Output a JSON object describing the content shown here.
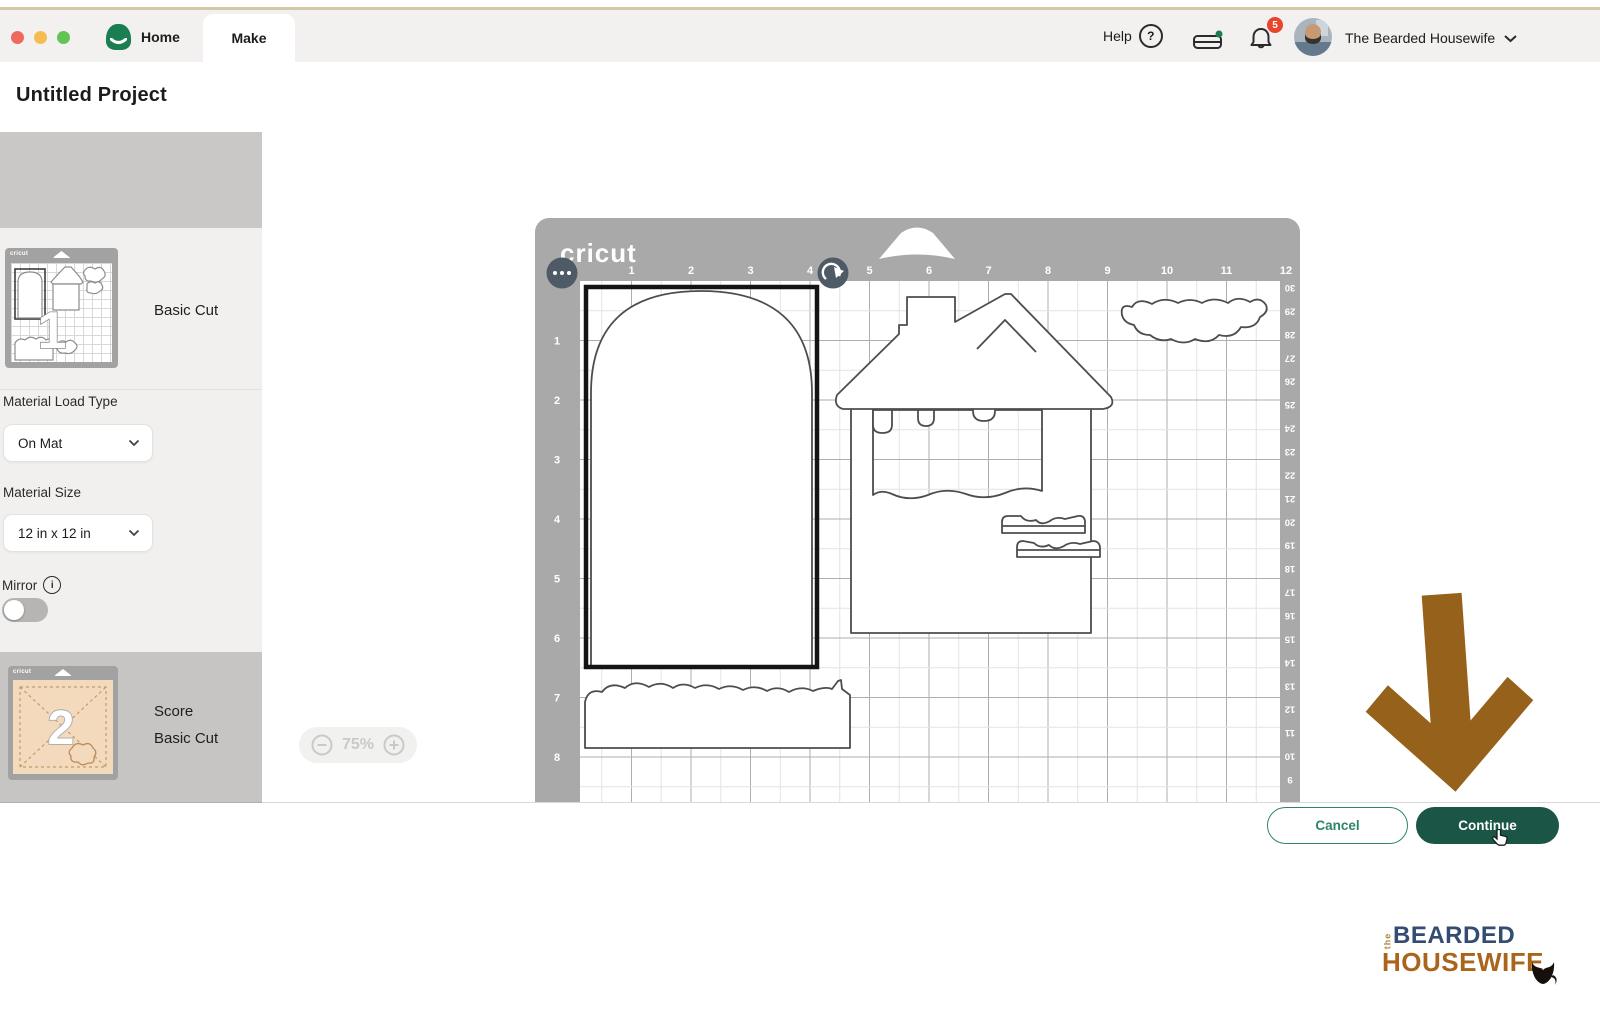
{
  "window": {
    "traffic_lights": [
      "close",
      "minimize",
      "zoom"
    ]
  },
  "header": {
    "home_tab": "Home",
    "make_tab": "Make",
    "help_label": "Help",
    "notification_count": "5",
    "account_name": "The Bearded Housewife"
  },
  "page": {
    "title": "Untitled Project"
  },
  "sidebar": {
    "project_copies_label": "Project copies:",
    "project_copies_value": "1",
    "apply_label": "Apply",
    "mat1": {
      "number": "1",
      "label": "Basic Cut"
    },
    "material_load_type_label": "Material Load Type",
    "material_load_type_value": "On Mat",
    "material_size_label": "Material Size",
    "material_size_value": "12 in x 12 in",
    "mirror_label": "Mirror",
    "mat2": {
      "number": "2",
      "label_line1": "Score",
      "label_line2": "Basic Cut"
    }
  },
  "canvas": {
    "mat_brand": "cricut",
    "zoom_level": "75%",
    "top_ruler": [
      1,
      2,
      3,
      4,
      5,
      6,
      7,
      8,
      9,
      10,
      11,
      12
    ],
    "left_ruler": [
      1,
      2,
      3,
      4,
      5,
      6,
      7,
      8
    ],
    "right_ruler": [
      30,
      29,
      28,
      27,
      26,
      25,
      24,
      23,
      22,
      21,
      20,
      19,
      18,
      17,
      16,
      15,
      14,
      13,
      12,
      11,
      10,
      9
    ]
  },
  "footer": {
    "cancel_label": "Cancel",
    "continue_label": "Continue"
  },
  "watermark": {
    "prefix": "the",
    "line1": "BEARDED",
    "line2": "HOUSEWIFE"
  },
  "colors": {
    "continue_green": "#1a5546",
    "cancel_green": "#2f8468",
    "apply_green": "#2e8566",
    "brand_green": "#1b7e52",
    "badge_red": "#e8442e",
    "arrow_brown": "#96611a",
    "watermark_navy": "#334c70",
    "watermark_brown": "#aa651b"
  }
}
